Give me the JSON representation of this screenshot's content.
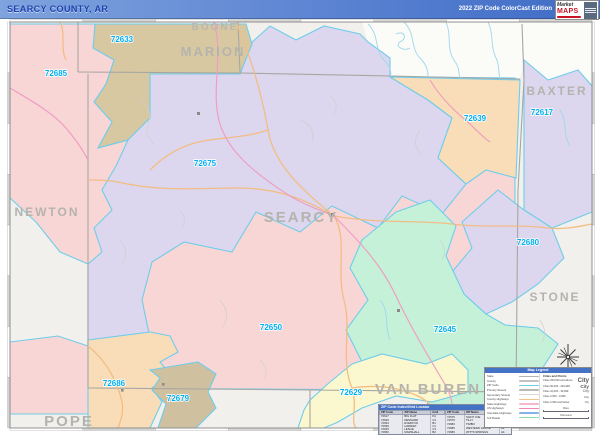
{
  "header": {
    "title": "SEARCY COUNTY, AR",
    "edition": "2022 ZIP Code ColorCast Edition",
    "logo_brand_top": "Market",
    "logo_brand_bottom": "MAPS"
  },
  "map": {
    "county_labels": [
      {
        "name": "BOONE"
      },
      {
        "name": "MARION"
      },
      {
        "name": "BAXTER"
      },
      {
        "name": "NEWTON"
      },
      {
        "name": "SEARCY"
      },
      {
        "name": "STONE"
      },
      {
        "name": "VAN BUREN"
      },
      {
        "name": "POPE"
      }
    ],
    "zip_labels": [
      "72633",
      "72685",
      "72675",
      "72639",
      "72617",
      "72680",
      "72650",
      "72645",
      "72686",
      "72679",
      "72629"
    ]
  },
  "zip_table": {
    "title": "ZIP Code Index/Grid Locator",
    "columns": [
      "ZIP Code",
      "ZIP Name",
      "Grid"
    ],
    "rows_left": [
      [
        "72617",
        "BIG FLAT",
        "D1"
      ],
      [
        "72629",
        "DENNARD",
        "C4"
      ],
      [
        "72633",
        "EVERTON",
        "B1"
      ],
      [
        "72639",
        "HARRIET",
        "C1"
      ],
      [
        "72645",
        "LESLIE",
        "C3"
      ],
      [
        "72650",
        "MARSHALL",
        "B2"
      ]
    ],
    "rows_right": [
      [
        "72675",
        "SAINT JOE",
        "B1"
      ],
      [
        "72679",
        "TILLY",
        "B4"
      ],
      [
        "72680",
        "TIMBO",
        "D3"
      ],
      [
        "72685",
        "WESTERN GROVE",
        "A1"
      ],
      [
        "72686",
        "WITTS SPRINGS",
        "A4"
      ]
    ]
  },
  "legend": {
    "title": "Map Legend",
    "line_items": [
      {
        "label": "State",
        "color": "#b3b3b3"
      },
      {
        "label": "County",
        "color": "#c4c2be"
      },
      {
        "label": "ZIP Code",
        "color": "#6fcdea"
      },
      {
        "label": "Primary Streets",
        "color": "#b9b9b9"
      },
      {
        "label": "Secondary Streets",
        "color": "#d8d8d8"
      },
      {
        "label": "County Highways",
        "color": "#f3c388"
      },
      {
        "label": "State Highways",
        "color": "#f5b9ce"
      },
      {
        "label": "US Highways",
        "color": "#ef8ab8"
      },
      {
        "label": "Interstate Highways",
        "color": "#86b2ec"
      },
      {
        "label": "Toll Roads",
        "color": "#8fdfae"
      }
    ],
    "cities_title": "Cities and Points",
    "city_classes": [
      {
        "label": "Cities 250,000 and above",
        "sample": "City"
      },
      {
        "label": "Cities 50,000 - 249,999",
        "sample": "City"
      },
      {
        "label": "Cities 10,000 - 49,999",
        "sample": "City"
      },
      {
        "label": "Cities 2,500 - 9,999",
        "sample": "City"
      },
      {
        "label": "Cities 2,500 and below",
        "sample": "City"
      }
    ],
    "scale_miles_label": "Miles",
    "scale_km_label": "Kilometers"
  },
  "map_colors": {
    "pink": "#f9d6d6",
    "tan": "#d8c8a2",
    "tan_dark": "#cfc0a0",
    "lavender": "#dcd7ee",
    "peach": "#f8ddb8",
    "mint": "#c5f1d9",
    "yellow": "#fbf8cf",
    "outside": "#f1f0ec",
    "zip_boundary": "#6fcdea",
    "zip_label": "#00aeef",
    "county_label": "#b5b3ae"
  }
}
